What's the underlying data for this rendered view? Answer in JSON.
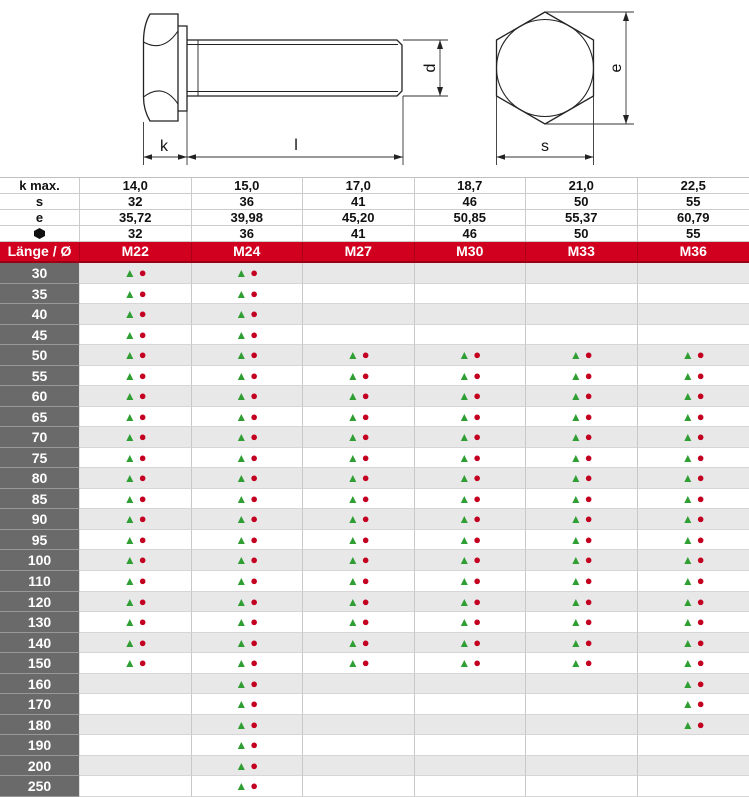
{
  "drawing": {
    "dim_labels": {
      "k": "k",
      "l": "l",
      "d": "d",
      "e": "e",
      "s": "s"
    }
  },
  "table": {
    "spec_rows": [
      {
        "label": "k max.",
        "icon": false,
        "values": [
          "14,0",
          "15,0",
          "17,0",
          "18,7",
          "21,0",
          "22,5"
        ]
      },
      {
        "label": "s",
        "icon": false,
        "values": [
          "32",
          "36",
          "41",
          "46",
          "50",
          "55"
        ]
      },
      {
        "label": "e",
        "icon": false,
        "values": [
          "35,72",
          "39,98",
          "45,20",
          "50,85",
          "55,37",
          "60,79"
        ]
      },
      {
        "label": "hex-head-icon",
        "icon": true,
        "values": [
          "32",
          "36",
          "41",
          "46",
          "50",
          "55"
        ]
      }
    ],
    "header": {
      "corner": "Länge / Ø",
      "columns": [
        "M22",
        "M24",
        "M27",
        "M30",
        "M33",
        "M36"
      ]
    },
    "availability_symbols": {
      "triangle": "▲",
      "circle": "●"
    },
    "rows": [
      {
        "length": "30",
        "available": [
          true,
          true,
          false,
          false,
          false,
          false
        ]
      },
      {
        "length": "35",
        "available": [
          true,
          true,
          false,
          false,
          false,
          false
        ]
      },
      {
        "length": "40",
        "available": [
          true,
          true,
          false,
          false,
          false,
          false
        ]
      },
      {
        "length": "45",
        "available": [
          true,
          true,
          false,
          false,
          false,
          false
        ]
      },
      {
        "length": "50",
        "available": [
          true,
          true,
          true,
          true,
          true,
          true
        ]
      },
      {
        "length": "55",
        "available": [
          true,
          true,
          true,
          true,
          true,
          true
        ]
      },
      {
        "length": "60",
        "available": [
          true,
          true,
          true,
          true,
          true,
          true
        ]
      },
      {
        "length": "65",
        "available": [
          true,
          true,
          true,
          true,
          true,
          true
        ]
      },
      {
        "length": "70",
        "available": [
          true,
          true,
          true,
          true,
          true,
          true
        ]
      },
      {
        "length": "75",
        "available": [
          true,
          true,
          true,
          true,
          true,
          true
        ]
      },
      {
        "length": "80",
        "available": [
          true,
          true,
          true,
          true,
          true,
          true
        ]
      },
      {
        "length": "85",
        "available": [
          true,
          true,
          true,
          true,
          true,
          true
        ]
      },
      {
        "length": "90",
        "available": [
          true,
          true,
          true,
          true,
          true,
          true
        ]
      },
      {
        "length": "95",
        "available": [
          true,
          true,
          true,
          true,
          true,
          true
        ]
      },
      {
        "length": "100",
        "available": [
          true,
          true,
          true,
          true,
          true,
          true
        ]
      },
      {
        "length": "110",
        "available": [
          true,
          true,
          true,
          true,
          true,
          true
        ]
      },
      {
        "length": "120",
        "available": [
          true,
          true,
          true,
          true,
          true,
          true
        ]
      },
      {
        "length": "130",
        "available": [
          true,
          true,
          true,
          true,
          true,
          true
        ]
      },
      {
        "length": "140",
        "available": [
          true,
          true,
          true,
          true,
          true,
          true
        ]
      },
      {
        "length": "150",
        "available": [
          true,
          true,
          true,
          true,
          true,
          true
        ]
      },
      {
        "length": "160",
        "available": [
          false,
          true,
          false,
          false,
          false,
          true
        ]
      },
      {
        "length": "170",
        "available": [
          false,
          true,
          false,
          false,
          false,
          true
        ]
      },
      {
        "length": "180",
        "available": [
          false,
          true,
          false,
          false,
          false,
          true
        ]
      },
      {
        "length": "190",
        "available": [
          false,
          true,
          false,
          false,
          false,
          false
        ]
      },
      {
        "length": "200",
        "available": [
          false,
          true,
          false,
          false,
          false,
          false
        ]
      },
      {
        "length": "250",
        "available": [
          false,
          true,
          false,
          false,
          false,
          false
        ]
      }
    ]
  },
  "colors": {
    "header_red": "#d1001f",
    "header_red_dark": "#9b0013",
    "length_cell_gray": "#6a6a6a",
    "row_alt_gray": "#e8e8e8",
    "triangle_green": "#2f9e33",
    "dot_red": "#c40020"
  }
}
